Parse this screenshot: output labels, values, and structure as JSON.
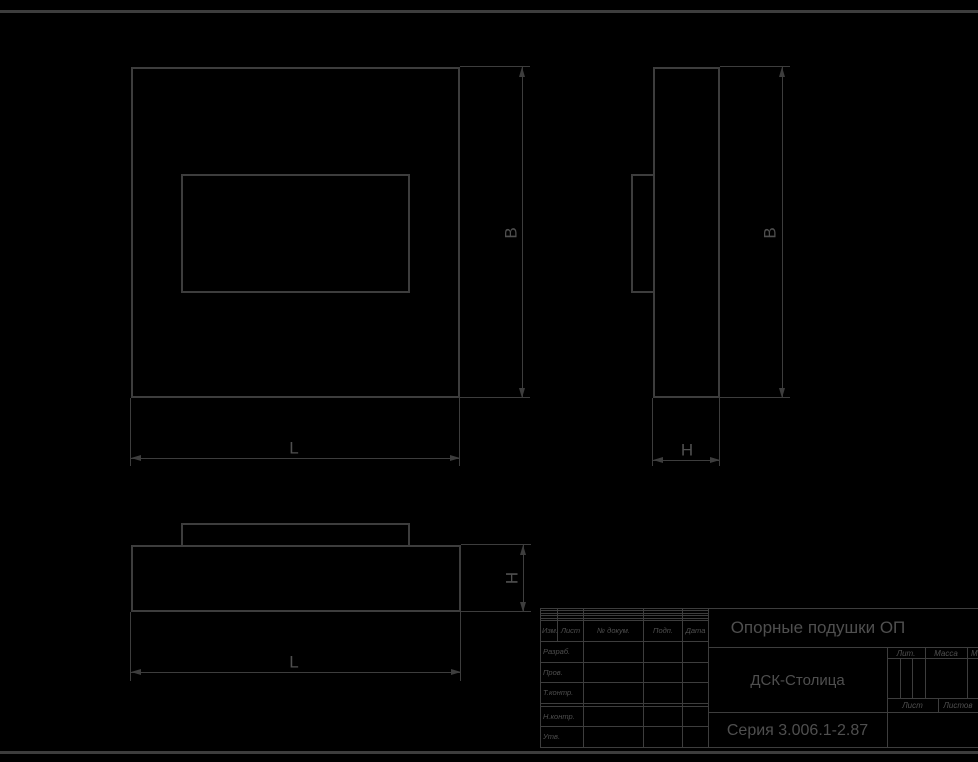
{
  "sheet": {
    "background": "#000000",
    "line_color": "#3d3d3d",
    "text_color": "#4f4f4f"
  },
  "views": {
    "front": {
      "label": "front-view",
      "dim_vertical": "B",
      "dim_horizontal": "L"
    },
    "side": {
      "label": "side-view",
      "dim_vertical": "B",
      "dim_horizontal": "H"
    },
    "bottom": {
      "label": "bottom-view",
      "dim_vertical": "H",
      "dim_horizontal": "L"
    }
  },
  "title_block": {
    "product_title": "Опорные подушки ОП",
    "organization": "ДСК-Столица",
    "document": "Серия 3.006.1-2.87",
    "revision_header": [
      "Изм.",
      "Лист",
      "№ докум.",
      "Подп.",
      "Дата"
    ],
    "signature_rows": [
      "Разраб.",
      "Пров.",
      "Т.контр.",
      "",
      "Н.контр.",
      "Утв."
    ],
    "right_headers": {
      "lit": "Лит.",
      "mass": "Масса",
      "scale": "Масштаб"
    },
    "sheet_labels": {
      "sheet": "Лист",
      "sheets": "Листов"
    }
  }
}
